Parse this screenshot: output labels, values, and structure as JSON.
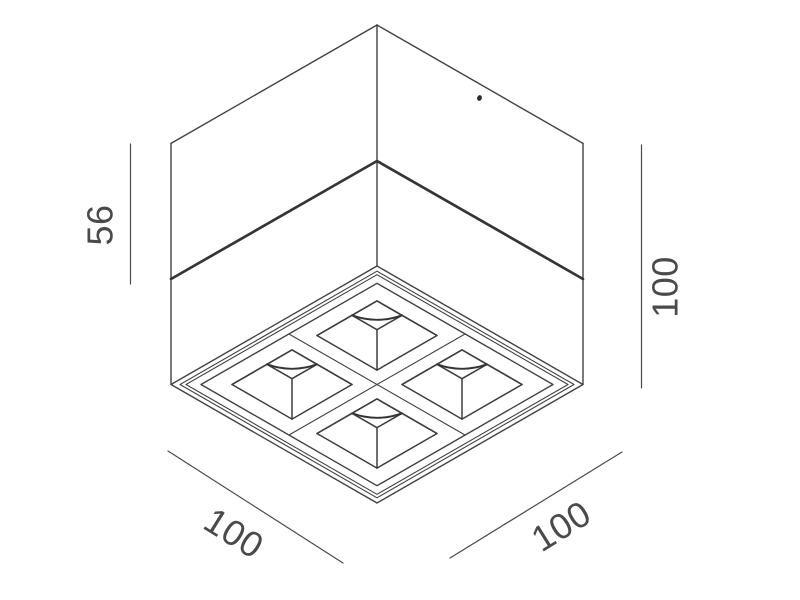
{
  "page": {
    "background": "#ffffff"
  },
  "drawing": {
    "description": "isometric worm's-eye technical line drawing of a cubic surface-mounted 4-cell LED downlight",
    "line_color": "#414141",
    "text_color": "#4a4a4a",
    "labels": {
      "upper_body_height": "56",
      "total_height": "100",
      "width_left": "100",
      "width_right": "100"
    }
  }
}
